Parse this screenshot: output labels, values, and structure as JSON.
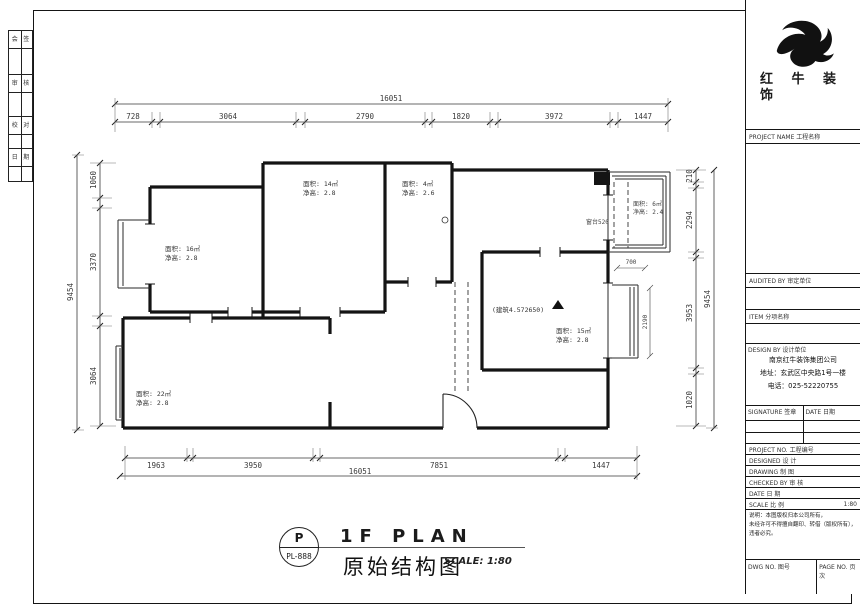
{
  "colors": {
    "line": "#1a1a1a",
    "dim": "#3a3a3a",
    "background": "#ffffff"
  },
  "left_strip": {
    "rows": [
      {
        "a": "会",
        "b": "签"
      },
      {
        "a": "审",
        "b": "核"
      },
      {
        "a": "校",
        "b": "对"
      },
      {
        "a": "日",
        "b": "期"
      }
    ]
  },
  "dims": {
    "top_total": "16051",
    "top_segments": [
      "728",
      "3064",
      "2790",
      "1820",
      "3972",
      "1447"
    ],
    "bottom_segments": [
      "1963",
      "3950",
      "7851",
      "1447"
    ],
    "bottom_total": "16051",
    "left_total": "9454",
    "left_segments": [
      "1060",
      "3370",
      "3064"
    ],
    "right_total": "9454",
    "right_segments": [
      "210",
      "2294",
      "3953",
      "1020"
    ]
  },
  "rooms": [
    {
      "line1": "面积: 16㎡",
      "line2": "净高: 2.8"
    },
    {
      "line1": "面积: 14㎡",
      "line2": "净高: 2.8"
    },
    {
      "line1": "面积: 4㎡",
      "line2": "净高: 2.6"
    },
    {
      "line1": "面积: 6㎡",
      "line2": "净高: 2.4"
    },
    {
      "line1": "面积: 15㎡",
      "line2": "净高: 2.8"
    },
    {
      "line1": "面积: 22㎡",
      "line2": "净高: 2.8"
    }
  ],
  "ann": {
    "elevation": "(建筑4.572650)",
    "sill": "窗台520",
    "dim_a": "700",
    "dim_b": "2190"
  },
  "titlebar": {
    "bubble_top": "P",
    "bubble_bottom": "PL-888",
    "title_en": "1F PLAN",
    "title_cn": "原始结构图",
    "scale_text": "SCALE: 1:80"
  },
  "title_block": {
    "company_logo_text": "红 牛 装 饰",
    "project_name_label": "PROJECT NAME 工程名称",
    "audit_label": "AUDITED BY 审定单位",
    "item_label": "ITEM 分项名称",
    "design_by_label": "DESIGN BY 设计单位",
    "company_lines": [
      "南京红牛装饰集团公司",
      "地址：玄武区中央路1号一楼",
      "电话：025-52220755"
    ],
    "stamp_left_label": "SIGNATURE 签章",
    "stamp_right_label": "DATE 日期",
    "fields": [
      {
        "label": "PROJECT NO. 工程编号",
        "value": ""
      },
      {
        "label": "DESIGNED 设 计",
        "value": ""
      },
      {
        "label": "DRAWING 制 图",
        "value": ""
      },
      {
        "label": "CHECKED BY 审 核",
        "value": ""
      },
      {
        "label": "DATE 日 期",
        "value": ""
      },
      {
        "label": "SCALE 比 例",
        "value": "1:80"
      }
    ],
    "notes": [
      "说明：本图版权归本公司所有，",
      "未经许可不得擅自翻印、转借（版权所有），",
      "违者必究。"
    ],
    "dwg_no_label": "DWG NO. 图号",
    "page_label": "PAGE NO. 页次"
  }
}
